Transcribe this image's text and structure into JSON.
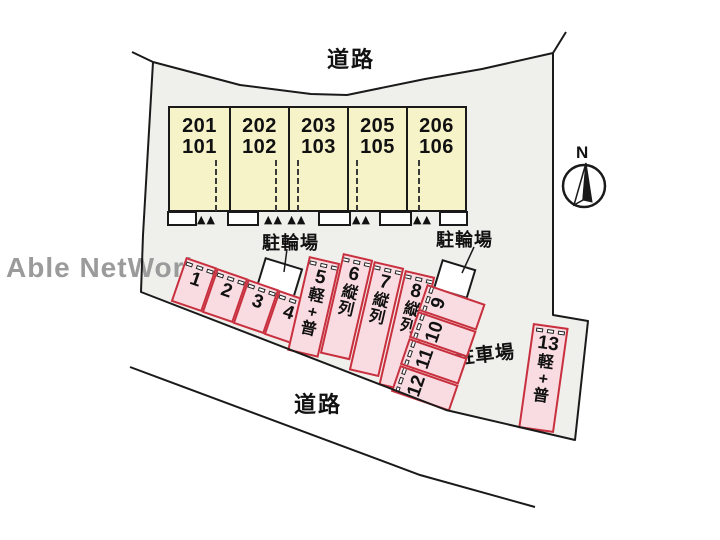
{
  "plan": {
    "road_top": "道路",
    "road_bottom": "道路",
    "parking_lot_label": "駐車場",
    "bike_parking_labels": [
      "駐輪場",
      "駐輪場"
    ],
    "compass_label": "N",
    "watermark": "Able NetWork"
  },
  "building": {
    "units": [
      {
        "upper": "201",
        "lower": "101"
      },
      {
        "upper": "202",
        "lower": "102"
      },
      {
        "upper": "203",
        "lower": "103"
      },
      {
        "upper": "205",
        "lower": "105"
      },
      {
        "upper": "206",
        "lower": "106"
      }
    ]
  },
  "parking": {
    "spaces": [
      {
        "number": "1",
        "note": ""
      },
      {
        "number": "2",
        "note": ""
      },
      {
        "number": "3",
        "note": ""
      },
      {
        "number": "4",
        "note": ""
      },
      {
        "number": "5",
        "note": "軽+普"
      },
      {
        "number": "6",
        "note": "縦列"
      },
      {
        "number": "7",
        "note": "縦列"
      },
      {
        "number": "8",
        "note": "縦列"
      },
      {
        "number": "9",
        "note": ""
      },
      {
        "number": "10",
        "note": ""
      },
      {
        "number": "11",
        "note": ""
      },
      {
        "number": "12",
        "note": ""
      },
      {
        "number": "13",
        "note": "軽+普"
      }
    ]
  },
  "icons": {
    "entrance_steps": "▲",
    "compass_needle": "north-needle"
  },
  "colors": {
    "site_fill": "#efefec",
    "outline": "#1a1a1a",
    "building_fill": "#f7f3c9",
    "parking_fill": "#f9dce2",
    "parking_border": "#c8303e",
    "watermark": "#9b9b9b",
    "text": "#111111"
  }
}
